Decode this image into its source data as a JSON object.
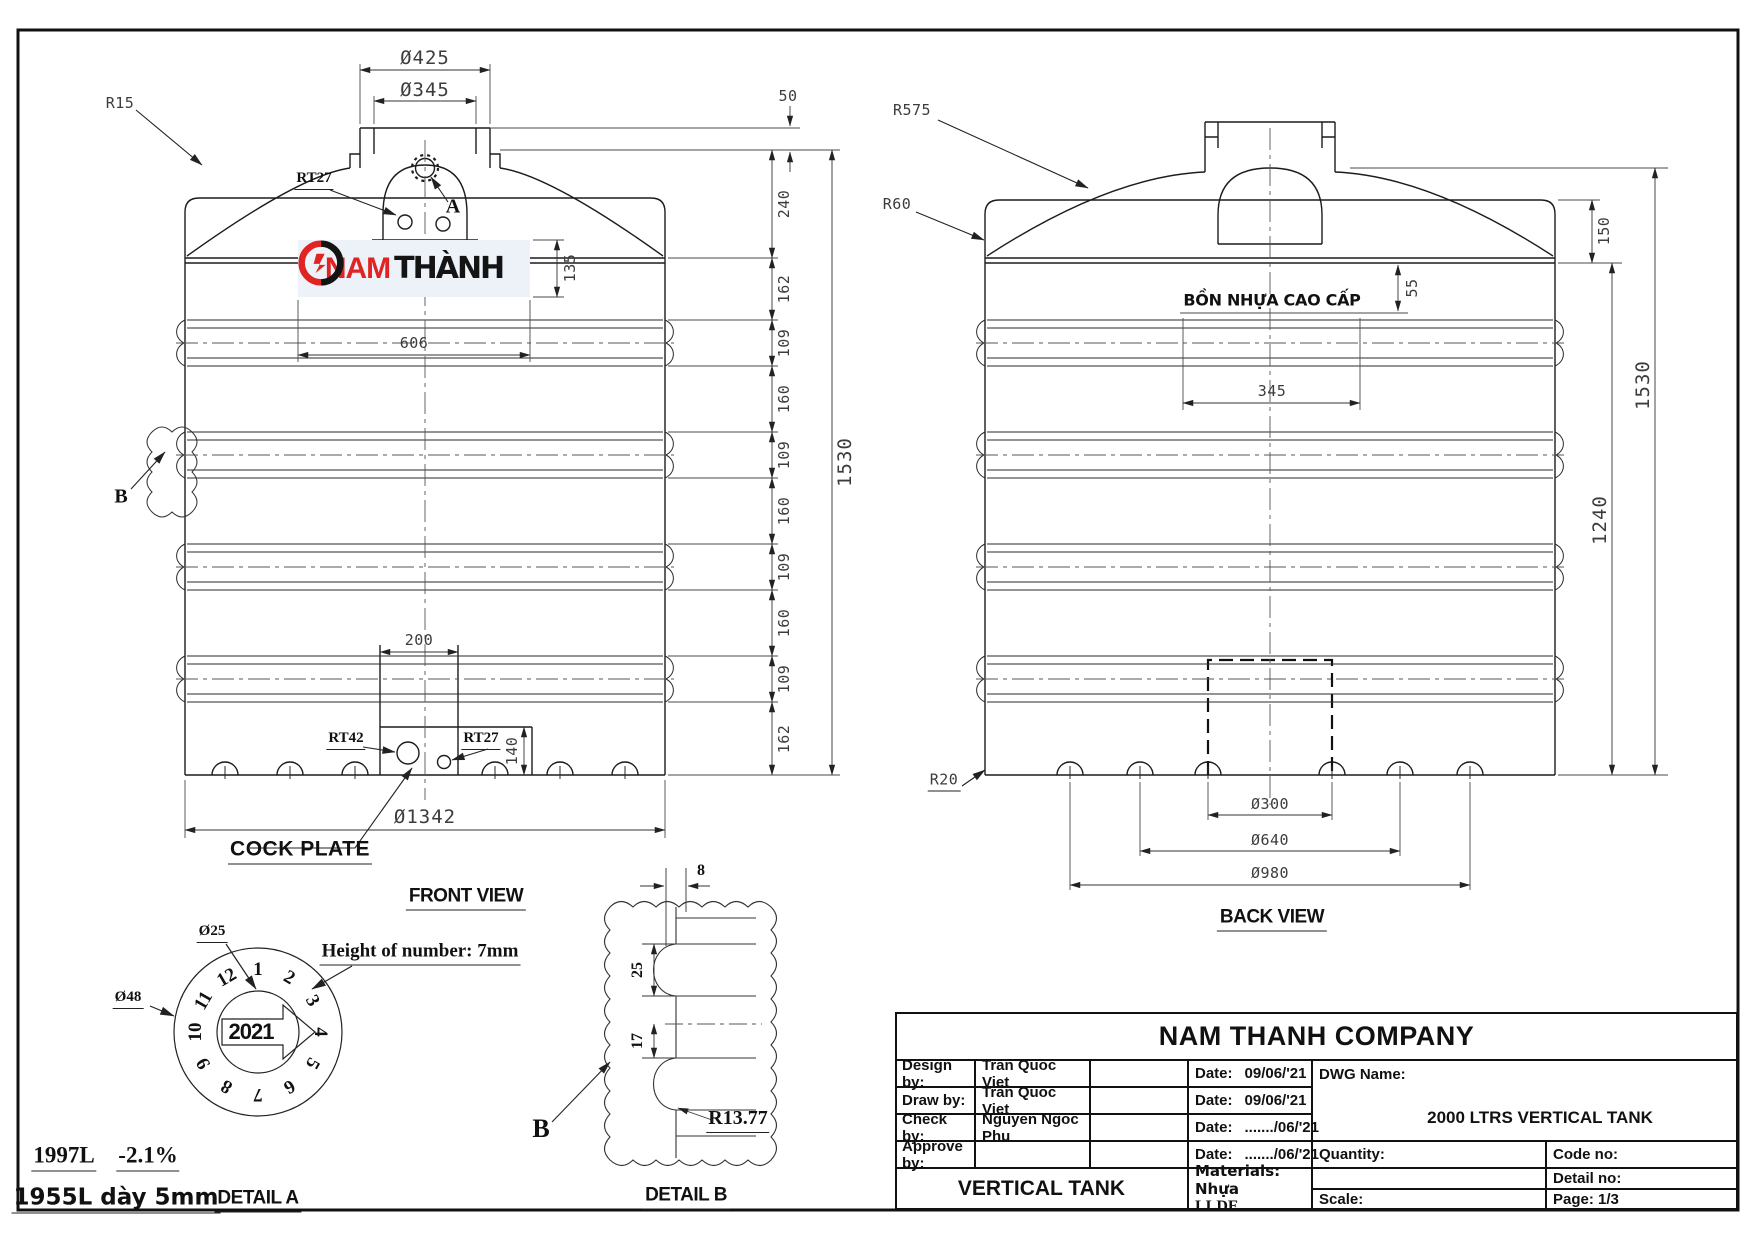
{
  "front_view": {
    "caption": "FRONT VIEW",
    "dims": {
      "neck_outer": "Ø425",
      "neck_inner": "Ø345",
      "top_offset": "50",
      "logo_height": "135",
      "logo_width": "606",
      "plate_width": "200",
      "plate_height": "140",
      "base_diameter": "Ø1342",
      "overall_height": "1530"
    },
    "chain": [
      "240",
      "162",
      "109",
      "160",
      "109",
      "160",
      "109",
      "160",
      "109",
      "162"
    ],
    "labels": {
      "radius_top": "R15",
      "vent_hole": "RT27",
      "hub_mark": "A",
      "rib_detail": "B",
      "drain_large": "RT42",
      "drain_small": "RT27",
      "cock_plate": "COCK PLATE"
    }
  },
  "back_view": {
    "caption": "BACK VIEW",
    "body_text": "BỒN NHỰA CAO CẤP",
    "dims": {
      "shoulder_height": "150",
      "text_offset": "55",
      "text_width": "345",
      "body_height": "1240",
      "overall_height": "1530",
      "inner_circle": "Ø300",
      "middle_circle": "Ø640",
      "outer_circle": "Ø980"
    },
    "labels": {
      "radius_dome": "R575",
      "radius_shoulder": "R60",
      "radius_bottom": "R20"
    }
  },
  "detail_a": {
    "caption": "DETAIL A",
    "dims": {
      "inner_circle": "Ø25",
      "outer_circle": "Ø48"
    },
    "note": "Height of number: 7mm",
    "year": "2021",
    "numbers": [
      "1",
      "2",
      "3",
      "4",
      "5",
      "6",
      "7",
      "8",
      "9",
      "10",
      "11",
      "12"
    ],
    "volume_full": "1997L",
    "tolerance": "-2.1%",
    "volume_wall": "1955L dày 5mm"
  },
  "detail_b": {
    "caption": "DETAIL B",
    "label": "B",
    "dims": {
      "rib_depth": "8",
      "rib_pitch": "25",
      "rib_gap": "17",
      "radius": "R13.77"
    }
  },
  "logo": {
    "text_red": "NAM",
    "text_black": "THÀNH",
    "color_red": "#e02424",
    "color_black": "#141414"
  },
  "title_block": {
    "company": "NAM THANH COMPANY",
    "rows": [
      {
        "label": "Design by:",
        "value": "Tran Quoc Viet",
        "date_label": "Date:",
        "date_value": "09/06/'21"
      },
      {
        "label": "Draw by:",
        "value": "Tran Quoc Viet",
        "date_label": "Date:",
        "date_value": "09/06/'21"
      },
      {
        "label": "Check by:",
        "value": "Nguyen Ngoc Phu",
        "date_label": "Date:",
        "date_value": "......./06/'21"
      },
      {
        "label": "Approve by:",
        "value": "",
        "date_label": "Date:",
        "date_value": "......./06/'21"
      }
    ],
    "dwg_name_label": "DWG Name:",
    "dwg_name_value": "2000 LTRS VERTICAL TANK",
    "product_name": "VERTICAL TANK",
    "materials_line1": "Materials: Nhựa",
    "materials_line2": "LLDE",
    "quantity_label": "Quantity:",
    "code_label": "Code no:",
    "detail_no_label": "Detail no:",
    "scale_label": "Scale:",
    "page_label": "Page: 1/3"
  }
}
